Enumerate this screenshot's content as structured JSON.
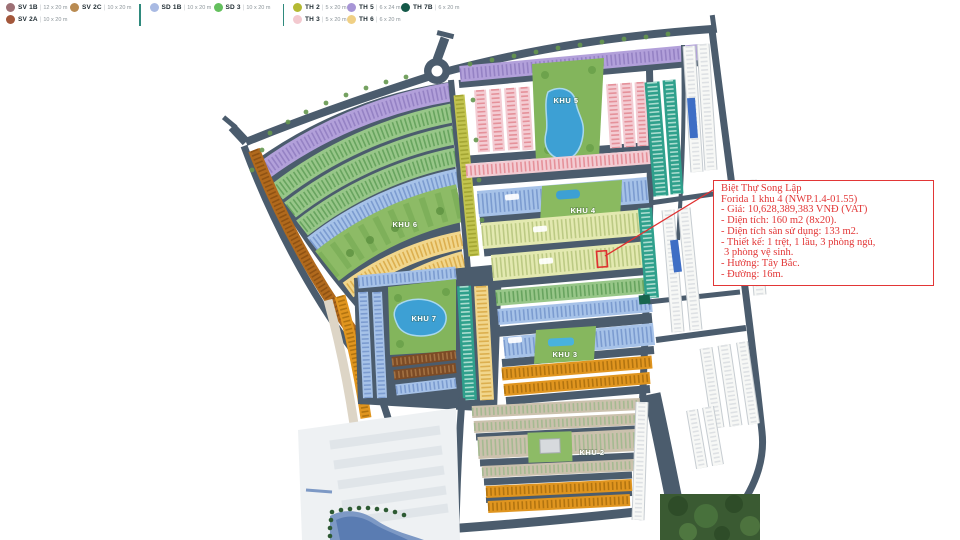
{
  "legend": {
    "items": [
      {
        "code": "SV 1B",
        "size": "12 x 20 m",
        "color": "#9d7075"
      },
      {
        "code": "SV 2C",
        "size": "10 x 20 m",
        "color": "#b98b52"
      },
      {
        "code": "SV 2A",
        "size": "10 x 20 m",
        "color": "#a3573b"
      },
      {
        "code": "SD 1B",
        "size": "10 x 20 m",
        "color": "#a9bae3"
      },
      {
        "code": "SD 3",
        "size": "10 x 20 m",
        "color": "#64c05e"
      },
      {
        "code": "TH 2",
        "size": "5 x 20 m",
        "color": "#b4ba33"
      },
      {
        "code": "TH 5",
        "size": "6 x 24 m",
        "color": "#a795d6"
      },
      {
        "code": "TH 7B",
        "size": "6 x 20 m",
        "color": "#145948"
      },
      {
        "code": "TH 3",
        "size": "5 x 20 m",
        "color": "#f3c9cf"
      },
      {
        "code": "TH 6",
        "size": "6 x 20 m",
        "color": "#f0d085"
      }
    ]
  },
  "map": {
    "labels": {
      "khu2": "KHU 2",
      "khu3": "KHU 3",
      "khu4": "KHU 4",
      "khu5": "KHU 5",
      "khu6": "KHU 6",
      "khu7": "KHU 7"
    }
  },
  "annotation": {
    "title": "Biệt Thự Song Lập",
    "subtitle": "Forida 1 khu 4 (NWP.1.4-01.55)",
    "lines": [
      "- Giá: 10,628,389,383 VNĐ (VAT)",
      "- Diện tích: 160 m2 (8x20).",
      "- Diện tích sàn sử dụng: 133 m2.",
      "- Thiết kế: 1 trệt, 1 lầu, 3 phòng ngủ,",
      "3 phòng vệ sinh.",
      "- Hướng: Tây Bắc.",
      "- Đường: 16m."
    ],
    "accent_color": "#e23636"
  },
  "colors": {
    "road": "#4b5c6d",
    "lake": "#3da0d4",
    "park": "#83b55c"
  }
}
